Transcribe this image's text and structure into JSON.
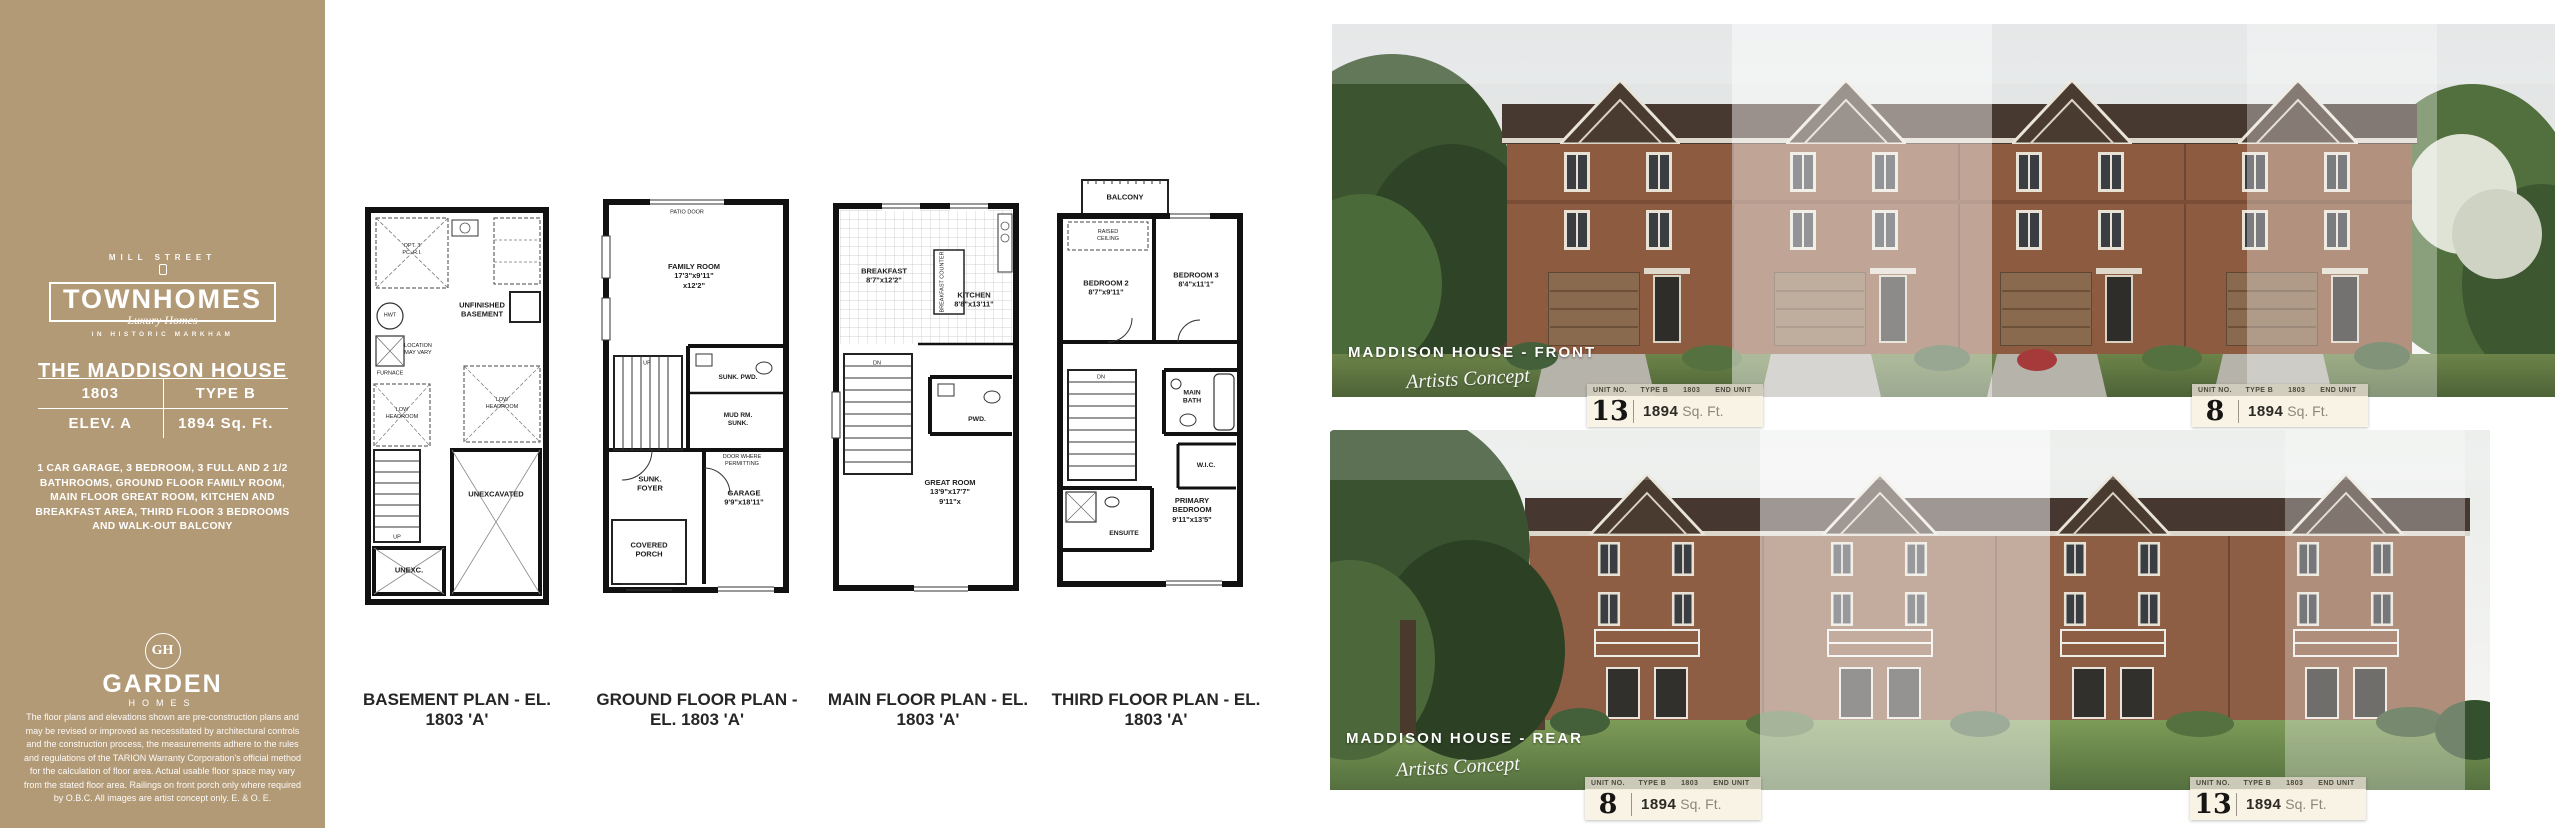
{
  "sidebar": {
    "logo": {
      "top": "MILL STREET",
      "main": "TOWNHOMES",
      "script": "Luxury Homes",
      "bottom": "IN HISTORIC MARKHAM"
    },
    "title": "THE MADDISON HOUSE",
    "spec": {
      "model": "1803",
      "type": "TYPE B",
      "elevation": "ELEV. A",
      "area": "1894 Sq. Ft."
    },
    "description": "1 CAR GARAGE, 3 BEDROOM, 3 FULL AND 2 1/2 BATHROOMS, GROUND FLOOR FAMILY ROOM, MAIN FLOOR GREAT ROOM, KITCHEN AND BREAKFAST AREA, THIRD FLOOR 3 BEDROOMS AND WALK-OUT BALCONY",
    "builder": {
      "monogram": "GH",
      "name": "GARDEN",
      "sub": "HOMES"
    },
    "disclaimer": "The floor plans and elevations shown are pre-construction plans and may be revised or improved as necessitated by architectural controls and the construction process, the measurements adhere to the rules and regulations of the TARION Warranty Corporation's official method for the calculation of floor area. Actual usable floor space may vary from the stated floor area. Railings on front porch only where required by O.B.C. All images are artist concept only. E. & O. E."
  },
  "plans": {
    "basement": {
      "caption": "BASEMENT PLAN - EL. 1803 'A'",
      "labels": {
        "opt_bath": "OPT. 3\nPC. R.I.",
        "hwt": "HWT",
        "furnace": "FURNACE",
        "unfinished": "UNFINISHED\nBASEMENT",
        "location": "LOCATION\nMAY VARY",
        "low_headroom": "LOW\nHEADROOM",
        "up": "UP",
        "unexc": "UNEXC.",
        "unexcavated": "UNEXCAVATED"
      }
    },
    "ground": {
      "caption": "GROUND FLOOR PLAN - EL. 1803 'A'",
      "labels": {
        "patio_door": "PATIO DOOR",
        "family_room": "FAMILY ROOM\n17'3\"x9'11\"\nx12'2\"",
        "sunk_pwd": "SUNK. PWD.",
        "mud_rm": "MUD RM.\nSUNK.",
        "door_note": "DOOR WHERE\nPERMITTING",
        "up": "UP",
        "garage": "GARAGE\n9'9\"x18'11\"",
        "sunk_foyer": "SUNK.\nFOYER",
        "covered_porch": "COVERED\nPORCH"
      }
    },
    "main": {
      "caption": "MAIN FLOOR PLAN - EL. 1803 'A'",
      "labels": {
        "breakfast": "BREAKFAST\n8'7\"x12'2\"",
        "kitchen": "KITCHEN\n8'8\"x13'11\"",
        "breakfast_counter": "BREAKFAST COUNTER",
        "pwd": "PWD.",
        "dn": "DN",
        "great_room": "GREAT ROOM\n13'9\"x17'7\"\n9'11\"x"
      }
    },
    "third": {
      "caption": "THIRD FLOOR PLAN - EL.  1803 'A'",
      "labels": {
        "balcony": "BALCONY",
        "raised_ceiling": "RAISED\nCEILING",
        "bedroom2": "BEDROOM 2\n8'7\"x9'11\"",
        "bedroom3": "BEDROOM 3\n8'4\"x11'1\"",
        "main_bath": "MAIN\nBATH",
        "wic": "W.I.C.",
        "dn": "DN",
        "ensuite": "ENSUITE",
        "primary": "PRIMARY\nBEDROOM\n9'11\"x13'5\""
      }
    }
  },
  "renders": {
    "badge_header": {
      "unit_no": "UNIT NO.",
      "type": "TYPE B",
      "model": "1803",
      "end_unit": "END UNIT"
    },
    "area_value": "1894",
    "area_unit": "Sq. Ft.",
    "front": {
      "title": "MADDISON HOUSE - FRONT",
      "concept": "Artists Concept",
      "badge_left_number": "13",
      "badge_right_number": "8"
    },
    "rear": {
      "title": "MADDISON HOUSE - REAR",
      "concept": "Artists Concept",
      "badge_left_number": "8",
      "badge_right_number": "13"
    }
  },
  "colors": {
    "sidebar_tan": "#b39a77",
    "brick": "#8d5e43",
    "roof": "#473830",
    "grass": "#6c8449",
    "badge_cream": "#f8f3e4"
  }
}
